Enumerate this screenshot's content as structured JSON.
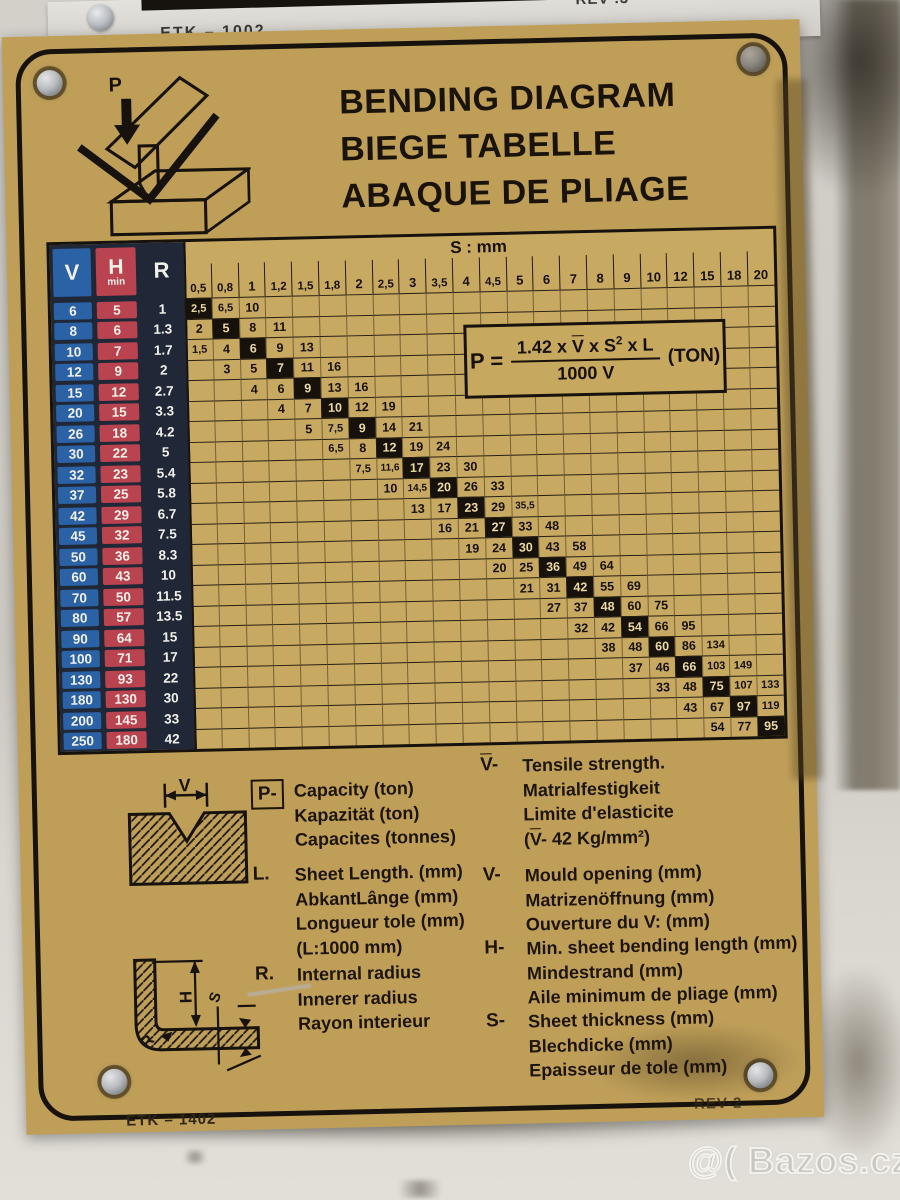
{
  "machine_strip": {
    "model_label": "ETK – 1002",
    "rev_label": "REV .3"
  },
  "plate": {
    "titles": [
      "BENDING DIAGRAM",
      "BIEGE TABELLE",
      "ABAQUE DE PLIAGE"
    ],
    "punch_label": "P",
    "footer_left": "ETK – 1402",
    "footer_right": "REV-2"
  },
  "formula": {
    "lhs": "P =",
    "num1": "1.42 x ",
    "num_v": "V",
    "num2": " x S",
    "num_exp": "2",
    "num3": " x L",
    "den": "1000 V",
    "unit": "(TON)"
  },
  "table": {
    "s_header": "S : mm",
    "v_header": "V",
    "h_header": "H",
    "h_header_sub": "min",
    "r_header": "R",
    "col_headers": [
      "0,5",
      "0,8",
      "1",
      "1,2",
      "1,5",
      "1,8",
      "2",
      "2,5",
      "3",
      "3,5",
      "4",
      "4,5",
      "5",
      "6",
      "7",
      "8",
      "9",
      "10",
      "12",
      "15",
      "18",
      "20"
    ],
    "rows": [
      {
        "v": "6",
        "h": "5",
        "r": "1",
        "values": [
          "2,5",
          "6,5",
          "10"
        ],
        "hl": 0
      },
      {
        "v": "8",
        "h": "6",
        "r": "1.3",
        "values": [
          "2",
          "5",
          "8",
          "11"
        ],
        "hl": 1
      },
      {
        "v": "10",
        "h": "7",
        "r": "1.7",
        "values": [
          "1,5",
          "4",
          "6",
          "9",
          "13"
        ],
        "hl": 2
      },
      {
        "v": "12",
        "h": "9",
        "r": "2",
        "values": [
          "3",
          "5",
          "7",
          "11",
          "16"
        ],
        "hl": 2
      },
      {
        "v": "15",
        "h": "12",
        "r": "2.7",
        "values": [
          "4",
          "6",
          "9",
          "13",
          "16"
        ],
        "hl": 2
      },
      {
        "v": "20",
        "h": "15",
        "r": "3.3",
        "values": [
          "4",
          "7",
          "10",
          "12",
          "19"
        ],
        "hl": 2
      },
      {
        "v": "26",
        "h": "18",
        "r": "4.2",
        "values": [
          "5",
          "7,5",
          "9",
          "14",
          "21"
        ],
        "hl": 2
      },
      {
        "v": "30",
        "h": "22",
        "r": "5",
        "values": [
          "6,5",
          "8",
          "12",
          "19",
          "24"
        ],
        "hl": 2
      },
      {
        "v": "32",
        "h": "23",
        "r": "5.4",
        "values": [
          "7,5",
          "11,6",
          "17",
          "23",
          "30"
        ],
        "hl": 2
      },
      {
        "v": "37",
        "h": "25",
        "r": "5.8",
        "values": [
          "10",
          "14,5",
          "20",
          "26",
          "33"
        ],
        "hl": 2
      },
      {
        "v": "42",
        "h": "29",
        "r": "6.7",
        "values": [
          "13",
          "17",
          "23",
          "29",
          "35,5"
        ],
        "hl": 2
      },
      {
        "v": "45",
        "h": "32",
        "r": "7.5",
        "values": [
          "16",
          "21",
          "27",
          "33",
          "48"
        ],
        "hl": 2
      },
      {
        "v": "50",
        "h": "36",
        "r": "8.3",
        "values": [
          "19",
          "24",
          "30",
          "43",
          "58"
        ],
        "hl": 2
      },
      {
        "v": "60",
        "h": "43",
        "r": "10",
        "values": [
          "20",
          "25",
          "36",
          "49",
          "64"
        ],
        "hl": 2
      },
      {
        "v": "70",
        "h": "50",
        "r": "11.5",
        "values": [
          "21",
          "31",
          "42",
          "55",
          "69"
        ],
        "hl": 2
      },
      {
        "v": "80",
        "h": "57",
        "r": "13.5",
        "values": [
          "27",
          "37",
          "48",
          "60",
          "75"
        ],
        "hl": 2
      },
      {
        "v": "90",
        "h": "64",
        "r": "15",
        "values": [
          "32",
          "42",
          "54",
          "66",
          "95"
        ],
        "hl": 2
      },
      {
        "v": "100",
        "h": "71",
        "r": "17",
        "values": [
          "38",
          "48",
          "60",
          "86",
          "134"
        ],
        "hl": 2
      },
      {
        "v": "130",
        "h": "93",
        "r": "22",
        "values": [
          "37",
          "46",
          "66",
          "103",
          "149"
        ],
        "hl": 2
      },
      {
        "v": "180",
        "h": "130",
        "r": "30",
        "values": [
          "33",
          "48",
          "75",
          "107",
          "133"
        ],
        "hl": 2
      },
      {
        "v": "200",
        "h": "145",
        "r": "33",
        "values": [
          "43",
          "67",
          "97",
          "119"
        ],
        "hl": 2
      },
      {
        "v": "250",
        "h": "180",
        "r": "42",
        "values": [
          "54",
          "77",
          "95"
        ],
        "hl": 2
      }
    ]
  },
  "legend_left": [
    {
      "symbol": "P-",
      "boxed": true,
      "lines": [
        "Capacity (ton)",
        "Kapazität (ton)",
        "Capacites (tonnes)"
      ]
    },
    {
      "symbol": "L.",
      "lines": [
        "Sheet Length. (mm)",
        "AbkantLânge (mm)",
        "Longueur tole (mm)",
        "(L:1000 mm)"
      ]
    },
    {
      "symbol": "R.",
      "lines": [
        "Internal radius",
        "Innerer radius",
        "Rayon interieur"
      ]
    }
  ],
  "legend_right": [
    {
      "symbol": "{V}-",
      "lines": [
        "Tensile strength.",
        "Matrialfestigkeit",
        "Limite d'elasticite",
        "({V}- 42 Kg/mm²)"
      ]
    },
    {
      "symbol": "V-",
      "lines": [
        "Mould opening (mm)",
        "Matrizenöffnung (mm)",
        "Ouverture du V: (mm)"
      ]
    },
    {
      "symbol": "H-",
      "lines": [
        "Min. sheet bending length (mm)",
        "Mindestrand (mm)",
        "Aile minimum de pliage (mm)"
      ]
    },
    {
      "symbol": "S-",
      "lines": [
        "Sheet thickness (mm)",
        "Blechdicke (mm)",
        "Epaisseur de tole (mm)"
      ]
    }
  ],
  "figures": {
    "die_dim_label": "V",
    "bent_r": "R",
    "bent_h": "H",
    "bent_s": "S"
  },
  "watermark": "@( Bazos.cz",
  "colors": {
    "plate_gold": "#bf9f58",
    "v_blue": "#2b62a6",
    "h_red": "#b9444f",
    "r_navy": "#202837",
    "highlight_bg": "#16110a",
    "highlight_text": "#ecd9a0",
    "line_black": "#17120c"
  }
}
